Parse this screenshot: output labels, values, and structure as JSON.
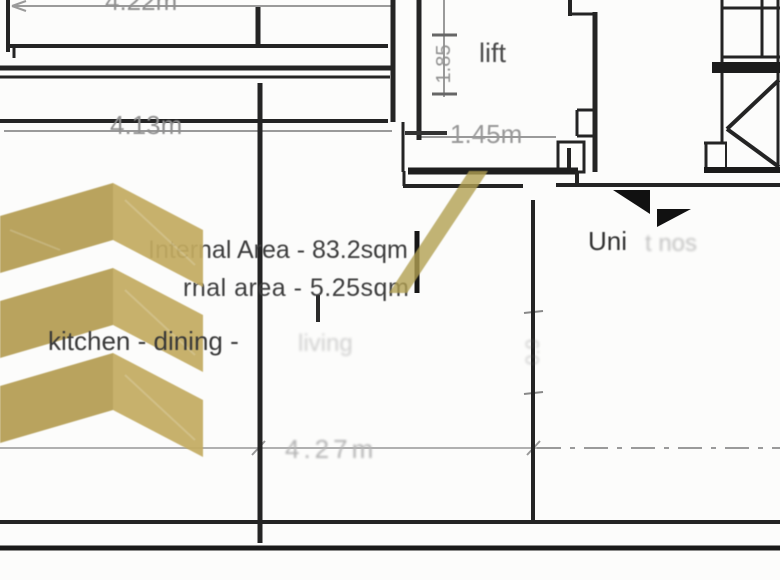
{
  "plan": {
    "dimensions": {
      "top_width": "4.22m",
      "corridor_width": "4.13m",
      "lift_door_width": "1.45m",
      "lift_depth": "1.85",
      "room_width": "4.27m",
      "right_opening": "0.9"
    },
    "labels": {
      "lift": "lift",
      "unit": "Uni",
      "unit_faint": "t nos",
      "internal_area": "Internal Area - 83.2sqm",
      "external_area_fragment": "rnal area - 5.25sqm",
      "room_name": "kitchen - dining -",
      "room_name_faint": "living"
    },
    "colors": {
      "watermark_gold_dark": "#b49d52",
      "watermark_gold_light": "#c3ac61",
      "wall": "#222222",
      "dimension_gray": "#909090",
      "label_gray": "#3c3c3c"
    }
  }
}
